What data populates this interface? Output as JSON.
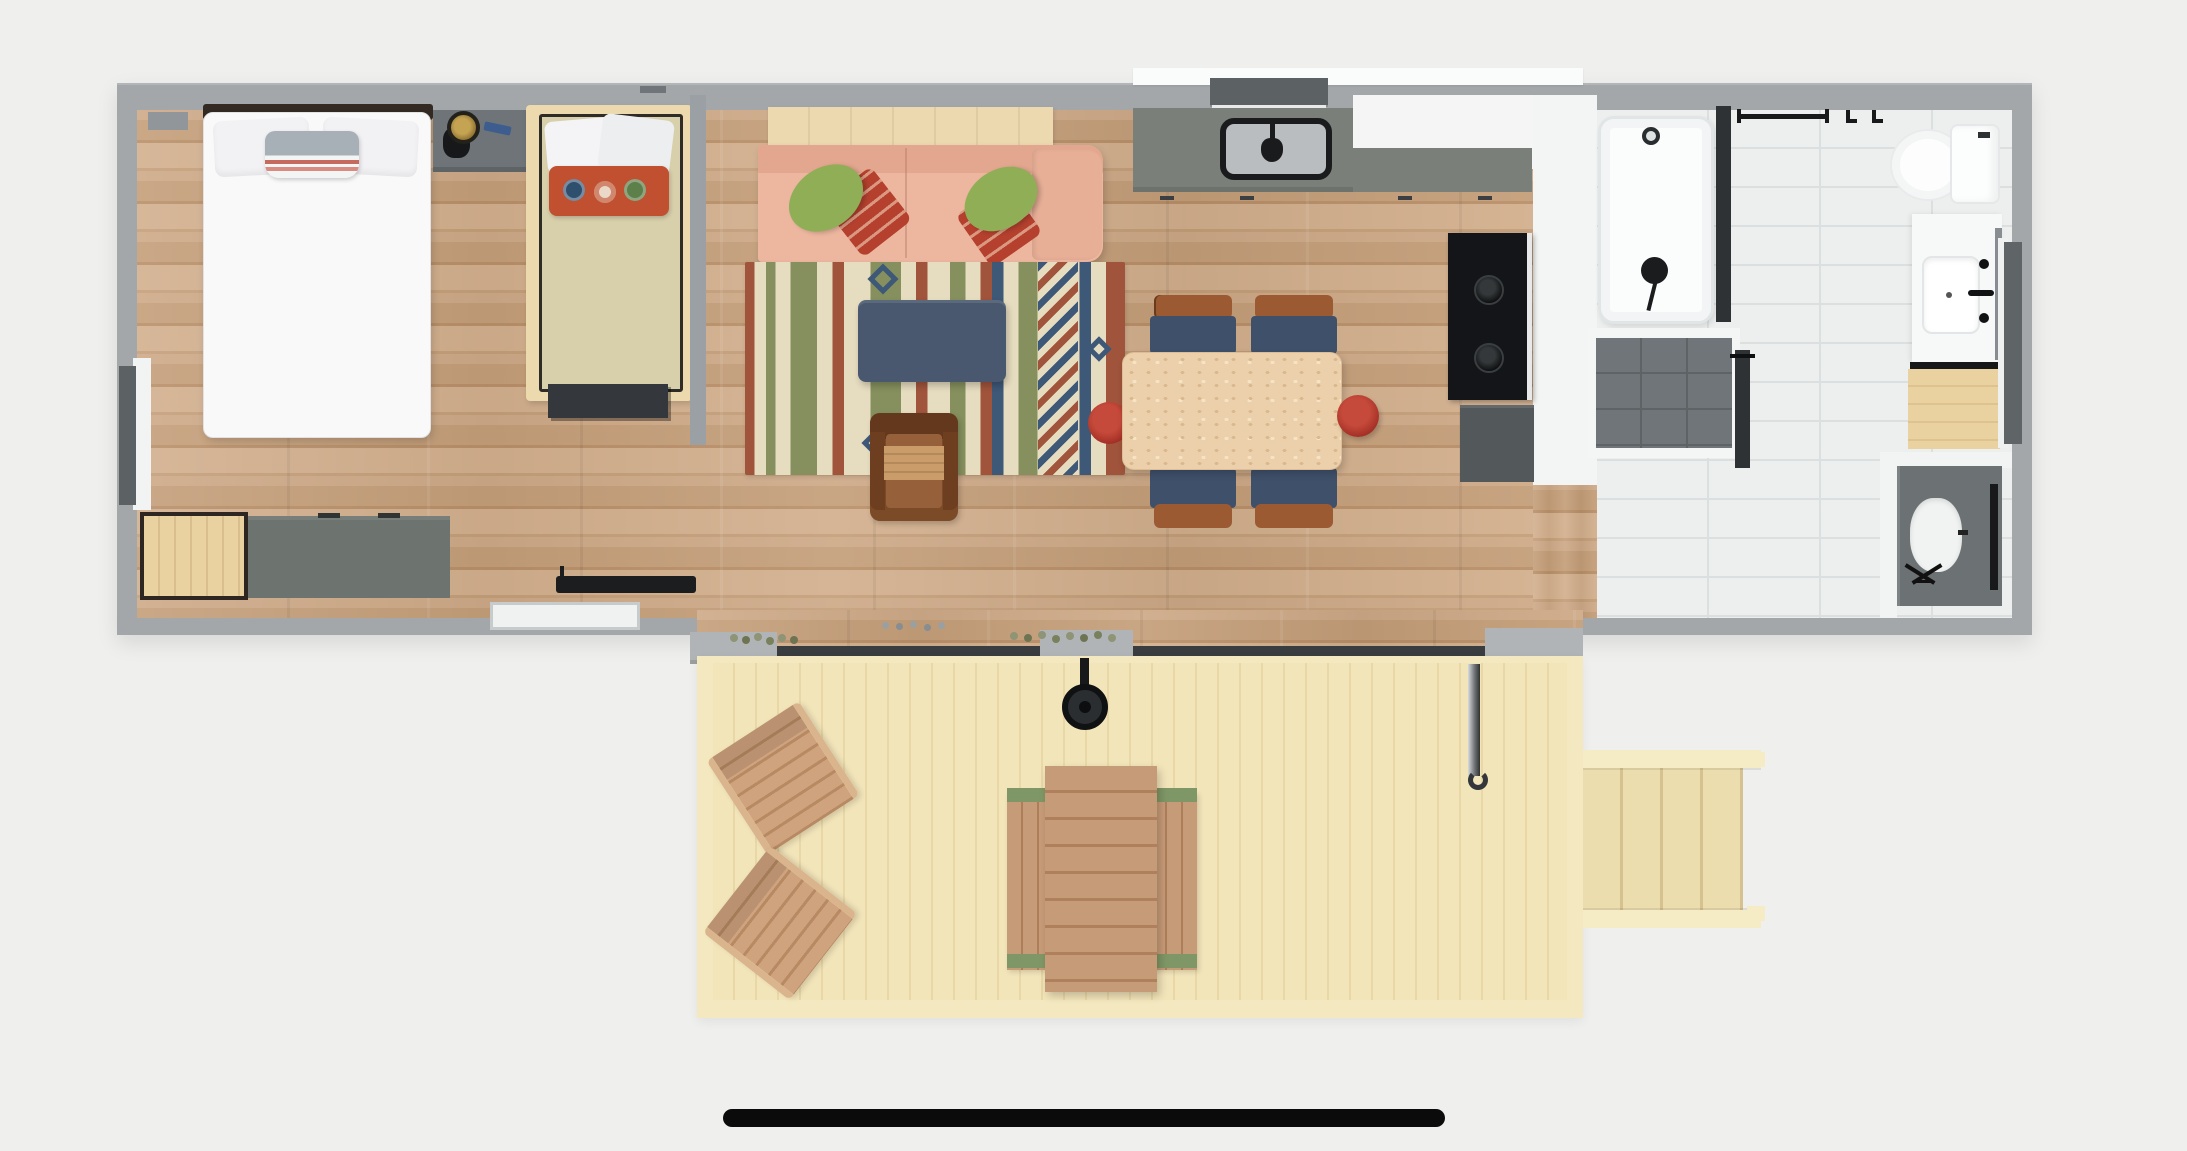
{
  "scene": {
    "name": "tiny-home-floor-plan",
    "view": "top-down-3d-render",
    "rooms": [
      {
        "name": "bedroom",
        "furniture": [
          "double-bed",
          "twin-bed",
          "nightstand",
          "wood-cabinet",
          "gray-dresser",
          "foot-bench",
          "sliding-door"
        ]
      },
      {
        "name": "living-room",
        "furniture": [
          "console-table",
          "sofa",
          "green-pillows",
          "red-pillows",
          "area-rug",
          "coffee-table",
          "armchair"
        ]
      },
      {
        "name": "kitchen",
        "furniture": [
          "counter",
          "sink",
          "window",
          "wall-oven",
          "base-cabinet",
          "dining-table",
          "dining-chairs",
          "red-stools"
        ]
      },
      {
        "name": "bathroom",
        "furniture": [
          "bathtub",
          "shower-head",
          "glass-panels",
          "shower-floor",
          "towel-bar",
          "toilet",
          "vanity",
          "mirror",
          "wood-stool",
          "utility-closet",
          "washer"
        ]
      },
      {
        "name": "deck",
        "furniture": [
          "adirondack-chairs",
          "picnic-table",
          "benches",
          "grill",
          "hook-pole",
          "planters",
          "stairs"
        ]
      }
    ]
  },
  "colors": {
    "background": "#efefed",
    "wall": "#a3a7aa",
    "wall_dark": "#5c6164",
    "floor_wood_1": "#cda987",
    "floor_wood_2": "#c49e79",
    "floor_wood_3": "#b98f68",
    "floor_wood_4": "#d2af8d",
    "tile": "#edefef",
    "tile_line": "#dcdfe0",
    "deck_1": "#f3e5ba",
    "deck_2": "#e9d8a6",
    "deck_frame": "#f4e8c0",
    "counter_gray": "#7a7f7a",
    "counter_white": "#f4f5f4",
    "appliance_black": "#131518",
    "cabinet_dark": "#53585b",
    "sofa": "#ecb69f",
    "sofa_arm": "#e8af97",
    "sofa_back": "#e3a78f",
    "pillow_green": "#8fae56",
    "pillow_red": "#b5402e",
    "rug_cream": "#e6dcc0",
    "rug_rust": "#a0543c",
    "rug_olive": "#85905e",
    "rug_navy": "#3e5878",
    "coffee_table": "#49586e",
    "armchair": "#7b4a27",
    "armchair_seat": "#96613a",
    "armchair_blanket": "#c99c69",
    "chair_navy": "#3f506a",
    "chair_rail": "#9c5a33",
    "stool_red": "#b23329",
    "table_wood": "#ecd0ab",
    "bed_white": "#f9f9fa",
    "blanket_tan": "#d8cfab",
    "bench_dark": "#34373b",
    "nightstand": "#6e7477",
    "dresser": "#6d736e",
    "cabinet_wood": "#ead1a0",
    "tub_white": "#fbfcfc",
    "shower_floor": "#6f7578",
    "glass_dark": "#2e3235",
    "closet_gray": "#6c7174",
    "adirondack": "#cfa37e",
    "picnic_wood": "#c69b78",
    "picnic_green": "#7f9766",
    "metal_gray": "#b0b4b6",
    "rail_dark": "#3a3d3f",
    "indicator": "#0b0b0c"
  },
  "footer": {
    "home_indicator": true
  }
}
